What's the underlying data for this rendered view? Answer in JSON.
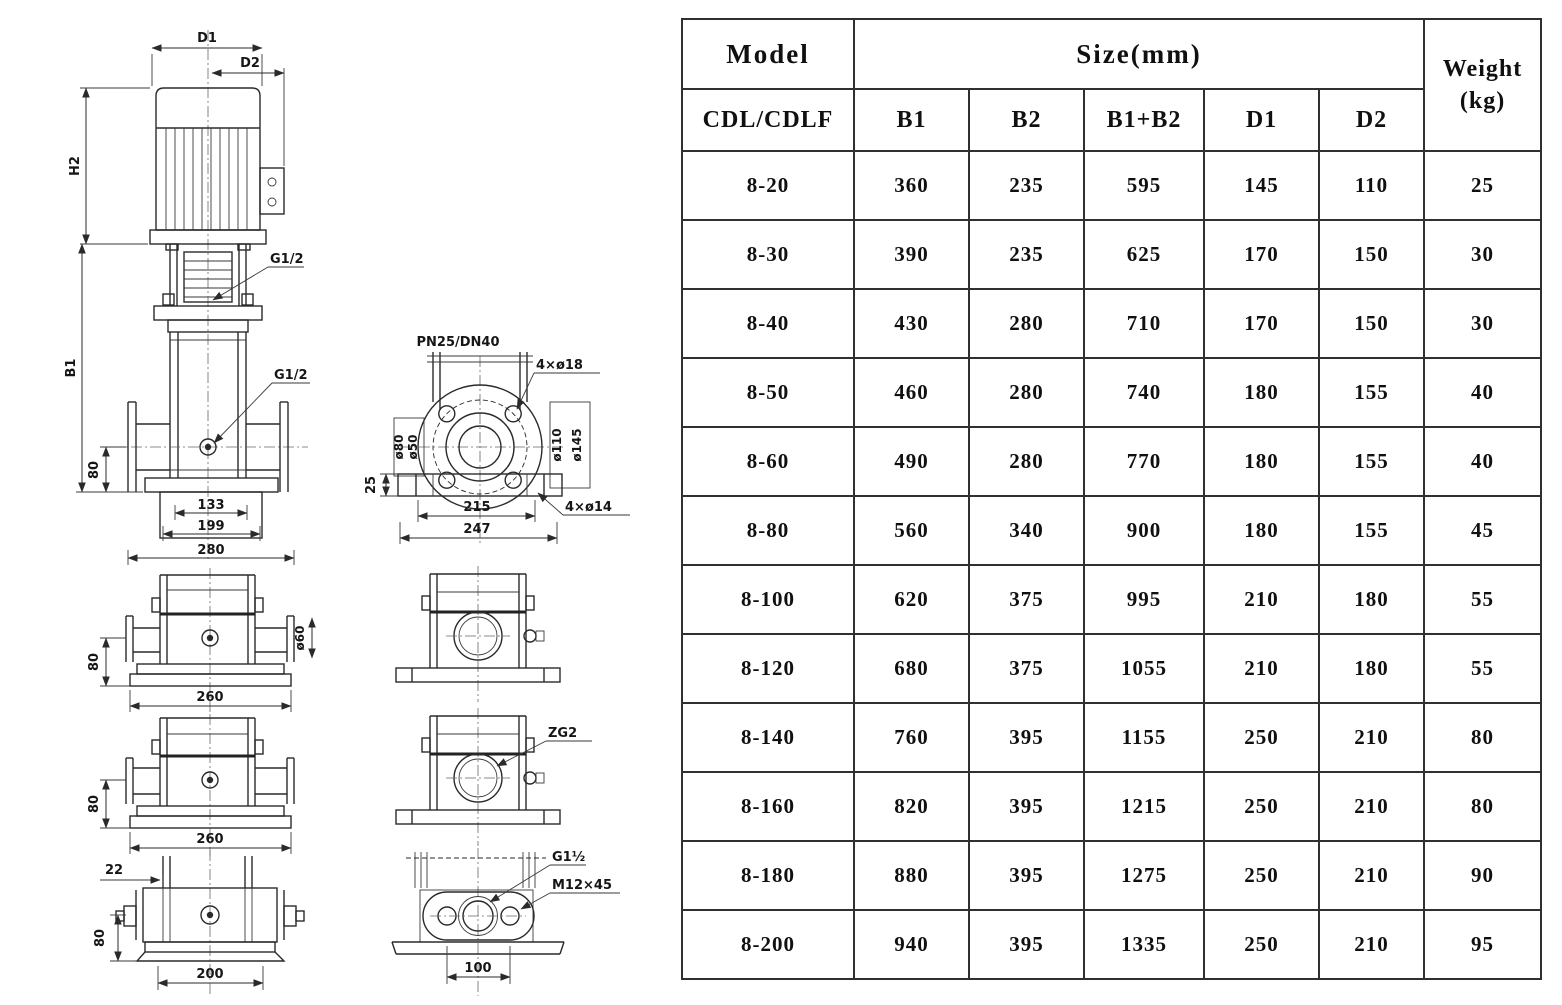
{
  "drawing": {
    "front_view": {
      "d1": "D1",
      "d2": "D2",
      "h2": "H2",
      "b1": "B1",
      "g12_top": "G1/2",
      "g12_side": "G1/2",
      "dim80": "80",
      "dim133": "133",
      "dim199": "199",
      "dim280": "280"
    },
    "flange_top_view": {
      "title": "PN25/DN40",
      "bolt_holes": "4×ø18",
      "d80": "ø80",
      "d50": "ø50",
      "d110": "ø110",
      "d145": "ø145",
      "dim25": "25",
      "dim215": "215",
      "dim247": "247",
      "base_holes": "4×ø14"
    },
    "side_view_upper": {
      "dim80": "80",
      "dim260": "260",
      "d60": "ø60"
    },
    "side_view_lower": {
      "dim80": "80",
      "dim260": "260"
    },
    "port_view_lower": {
      "zg2": "ZG2"
    },
    "bottom_view": {
      "dim22": "22",
      "dim80": "80",
      "dim200": "200"
    },
    "oval_flange_view": {
      "g1half": "G1½",
      "m12x45": "M12×45",
      "dim100": "100"
    }
  },
  "table": {
    "header": {
      "model": "Model",
      "model_sub": "CDL/CDLF",
      "size_group": "Size(mm)",
      "size_cols": [
        "B1",
        "B2",
        "B1+B2",
        "D1",
        "D2"
      ],
      "weight_line1": "Weight",
      "weight_line2": "(kg)"
    },
    "rows": [
      {
        "model": "8-20",
        "b1": "360",
        "b2": "235",
        "b1b2": "595",
        "d1": "145",
        "d2": "110",
        "weight": "25"
      },
      {
        "model": "8-30",
        "b1": "390",
        "b2": "235",
        "b1b2": "625",
        "d1": "170",
        "d2": "150",
        "weight": "30"
      },
      {
        "model": "8-40",
        "b1": "430",
        "b2": "280",
        "b1b2": "710",
        "d1": "170",
        "d2": "150",
        "weight": "30"
      },
      {
        "model": "8-50",
        "b1": "460",
        "b2": "280",
        "b1b2": "740",
        "d1": "180",
        "d2": "155",
        "weight": "40"
      },
      {
        "model": "8-60",
        "b1": "490",
        "b2": "280",
        "b1b2": "770",
        "d1": "180",
        "d2": "155",
        "weight": "40"
      },
      {
        "model": "8-80",
        "b1": "560",
        "b2": "340",
        "b1b2": "900",
        "d1": "180",
        "d2": "155",
        "weight": "45"
      },
      {
        "model": "8-100",
        "b1": "620",
        "b2": "375",
        "b1b2": "995",
        "d1": "210",
        "d2": "180",
        "weight": "55"
      },
      {
        "model": "8-120",
        "b1": "680",
        "b2": "375",
        "b1b2": "1055",
        "d1": "210",
        "d2": "180",
        "weight": "55"
      },
      {
        "model": "8-140",
        "b1": "760",
        "b2": "395",
        "b1b2": "1155",
        "d1": "250",
        "d2": "210",
        "weight": "80"
      },
      {
        "model": "8-160",
        "b1": "820",
        "b2": "395",
        "b1b2": "1215",
        "d1": "250",
        "d2": "210",
        "weight": "80"
      },
      {
        "model": "8-180",
        "b1": "880",
        "b2": "395",
        "b1b2": "1275",
        "d1": "250",
        "d2": "210",
        "weight": "90"
      },
      {
        "model": "8-200",
        "b1": "940",
        "b2": "395",
        "b1b2": "1335",
        "d1": "250",
        "d2": "210",
        "weight": "95"
      }
    ]
  },
  "colors": {
    "background": "#ffffff",
    "line": "#2a2a2a",
    "table_border": "#303030",
    "text": "#101010"
  }
}
